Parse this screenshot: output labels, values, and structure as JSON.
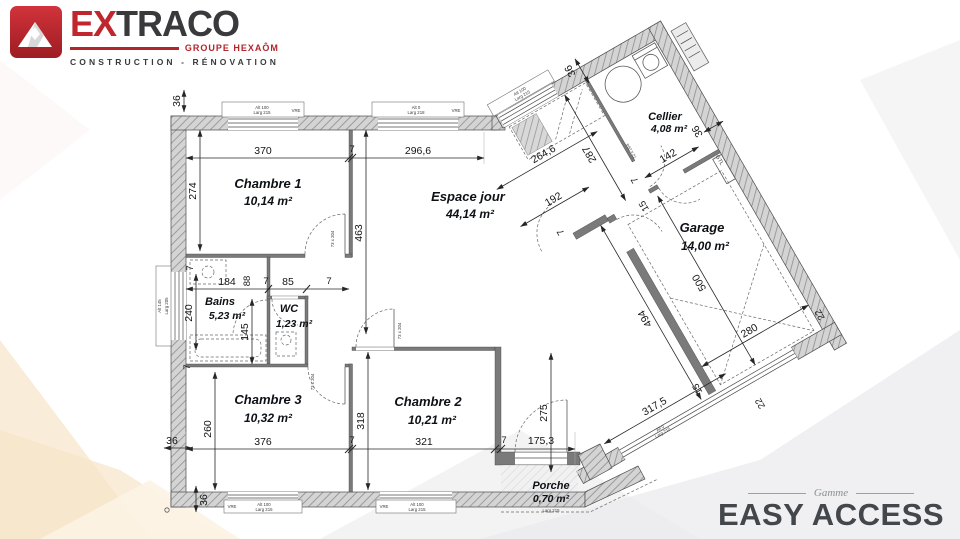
{
  "brand": {
    "ex": "EX",
    "traco": "TRACO",
    "group": "GROUPE HEXAÔM",
    "tagline": "CONSTRUCTION - RÉNOVATION",
    "red": "#c0262e",
    "dark": "#3a3a3d"
  },
  "gamme": {
    "pre": "Gamme",
    "name": "EASY ACCESS"
  },
  "rooms": {
    "chambre1": {
      "name": "Chambre 1",
      "area": "10,14 m²"
    },
    "espace": {
      "name": "Espace jour",
      "area": "44,14 m²"
    },
    "cellier": {
      "name": "Cellier",
      "area": "4,08 m²"
    },
    "garage": {
      "name": "Garage",
      "area": "14,00 m²"
    },
    "bains": {
      "name": "Bains",
      "area": "5,23 m²"
    },
    "wc": {
      "name": "WC",
      "area": "1,23 m²"
    },
    "chambre3": {
      "name": "Chambre 3",
      "area": "10,32 m²"
    },
    "chambre2": {
      "name": "Chambre 2",
      "area": "10,21 m²"
    },
    "porche": {
      "name": "Porche",
      "area": "0,70 m²"
    }
  },
  "dims": {
    "d36": "36",
    "d370": "370",
    "d7": "7",
    "d296": "296,6",
    "d274": "274",
    "d463": "463",
    "d264": "264,6",
    "d287": "287",
    "d192": "192",
    "d142": "142",
    "d15": "15",
    "d500": "500",
    "d494": "494",
    "d280": "280",
    "d22": "22",
    "d317": "317,5",
    "d240": "240",
    "d184": "184",
    "d88": "88",
    "d85": "85",
    "d145": "145",
    "d260": "260",
    "d376": "376",
    "d318": "318",
    "d321": "321",
    "d275": "275",
    "d175": "175,3"
  },
  "labels": {
    "gtl": "GTL",
    "vre": "VRE",
    "alt100": "Alt 100",
    "larg215": "Larg 215",
    "alt0": "Alt 0",
    "larg218": "Larg 218",
    "alt145": "Alt 145",
    "larg205": "Larg 205",
    "door73": "73 x 204",
    "door72": "72 x 204"
  }
}
